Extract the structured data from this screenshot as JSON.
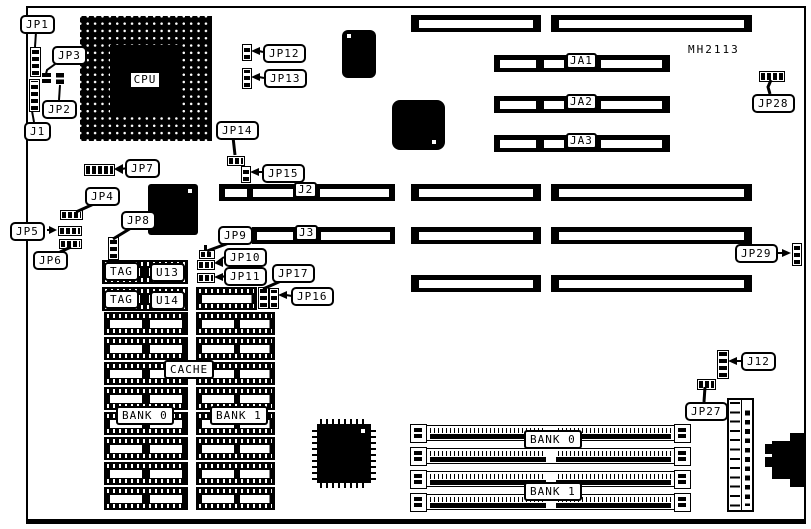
{
  "figure": {
    "model_number": "MH2113"
  },
  "cpu": {
    "label": "CPU"
  },
  "callouts": {
    "jp1": "JP1",
    "jp2": "JP2",
    "jp3": "JP3",
    "j1": "J1",
    "jp4": "JP4",
    "jp5": "JP5",
    "jp6": "JP6",
    "jp7": "JP7",
    "jp8": "JP8",
    "jp9": "JP9",
    "jp10": "JP10",
    "jp11": "JP11",
    "jp12": "JP12",
    "jp13": "JP13",
    "jp14": "JP14",
    "jp15": "JP15",
    "jp16": "JP16",
    "jp17": "JP17",
    "jp27": "JP27",
    "jp28": "JP28",
    "jp29": "JP29",
    "j12": "J12"
  },
  "slot_labels": {
    "ja1": "JA1",
    "ja2": "JA2",
    "ja3": "JA3",
    "j2": "J2",
    "j3": "J3"
  },
  "cache_area": {
    "tag_top": "TAG",
    "u13": "U13",
    "tag_bottom": "TAG",
    "u14": "U14",
    "cache": "CACHE",
    "bank0": "BANK 0",
    "bank1": "BANK 1"
  },
  "simm_area": {
    "bank0": "BANK 0",
    "bank1": "BANK 1"
  }
}
